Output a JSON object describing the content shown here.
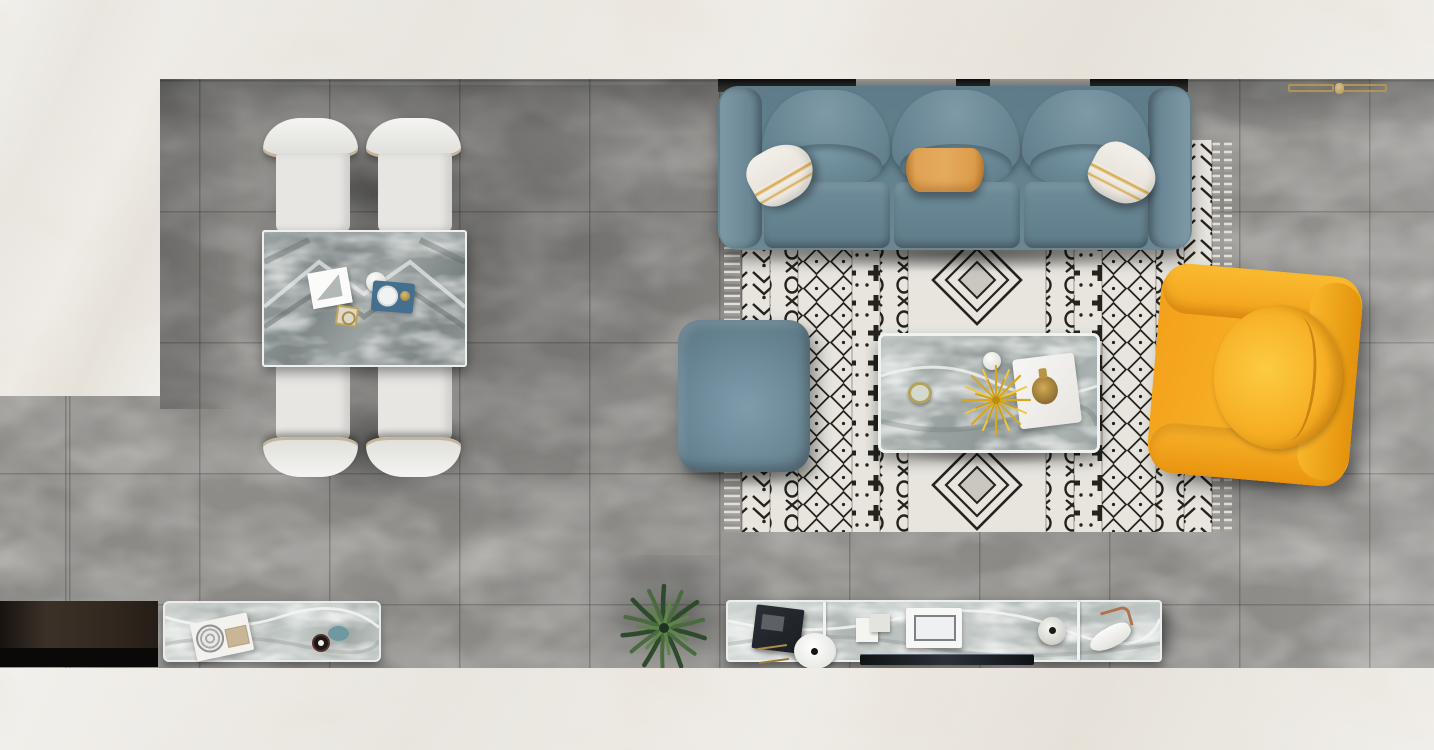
{
  "scene": {
    "description": "Top-down 3D render of a modern living and dining room with gray marble tile floor and white marble border",
    "view": "bird's-eye floor-plan view",
    "zones": [
      "dining area with table and four chairs",
      "living area with sofa, rug, coffee table, ottoman and armchair",
      "media wall with console, TV and sideboard"
    ],
    "objects": {
      "sofa": "Blue-gray three-seat leather sofa with two white-and-gold striped pillows and one orange pillow",
      "rug": "Black-and-white Moroccan geometric area rug with fringe on both ends",
      "ottoman": "Blue-gray square leather ottoman",
      "coffee_table": "Gray marble coffee table with yellow plant, white tray, gold decanter, white sphere and small green dish",
      "armchair": "Orange-yellow leather armchair with round seat cushion, facing the coffee table",
      "dining_table": "Gray marble dining table with magazine, white sphere, blue tray and gold dish",
      "dining_chair": "White upholstered dining chair with curved headrest",
      "tv_console": "Long marble media console with dark book, gold trinkets, white disc speaker, white sculpture, photo frame, round vase and designer high-heel shoe",
      "tv": "Dark flat TV panel lying along the console",
      "sideboard": "Marble-topped sideboard with tray, patterned plate, beige box, dark cup and teal dish",
      "dark_cabinet": "Dark wood low cabinet on the lower-left wall",
      "plant": "Green palm plant seen from above",
      "gold_rack": "Brass wall-mounted rack near the top-right wall",
      "wall_ledge": "Dark window ledge strip behind the sofa",
      "floor_gray": "Gray marble tile floor",
      "floor_white": "White marble floor border"
    }
  },
  "colors": {
    "floor-gray": "#8b8a87",
    "marble-white": "#ebe8e3",
    "sofa-blue": "#6d8b99",
    "sofa-blue-deep": "#5a7683",
    "ottoman-blue": "#6d8c9b",
    "pillow-white": "#efece5",
    "pillow-gold": "#d8a23e",
    "pillow-orange": "#dd9d4a",
    "rug-bg": "#f1eee7",
    "rug-ink": "#232019",
    "gold": "#b29255",
    "armchair-orange": "#f6a81f",
    "armchair-orange-light": "#fbc53c",
    "table-marble-dark": "#7e8687",
    "table-marble-light": "#aab3b1",
    "console-marble": "#c6cdca",
    "plant-green": "#4a6b3f",
    "plant-green-dark": "#2e4a2c",
    "cabinet-brown": "#32291f",
    "tv-black": "#15181b",
    "tray-blue": "#456f8e"
  }
}
